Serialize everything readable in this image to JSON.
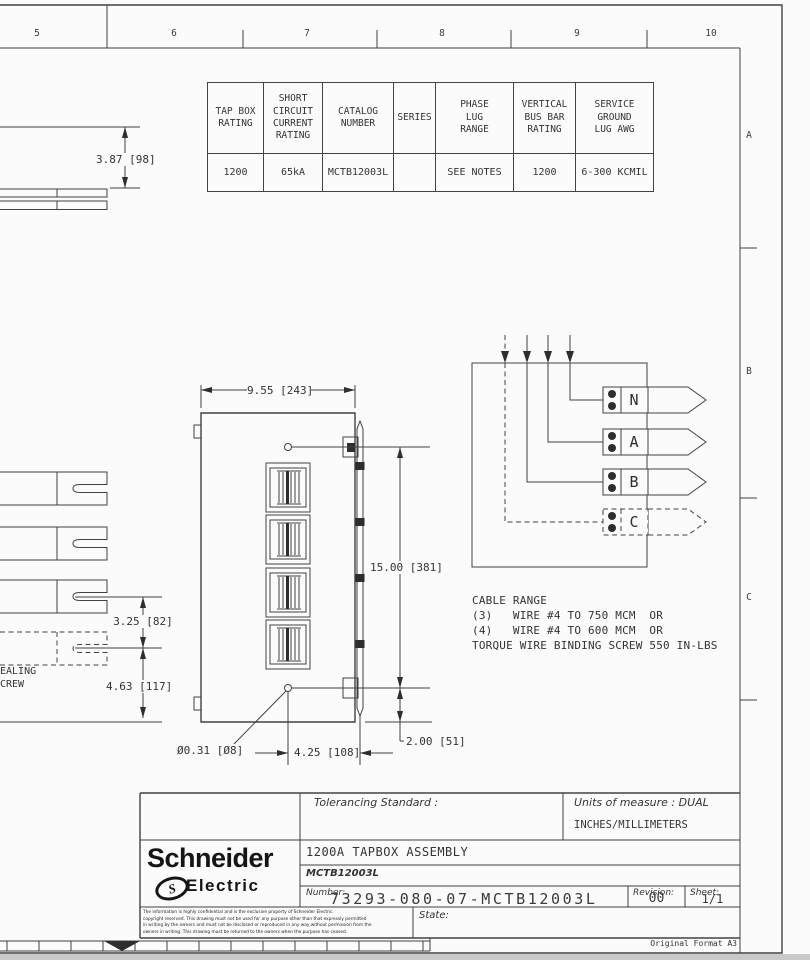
{
  "zones": {
    "top": [
      "5",
      "6",
      "7",
      "8",
      "9",
      "10"
    ],
    "right": [
      "A",
      "B",
      "C"
    ]
  },
  "spec_table": {
    "headers": [
      "TAP BOX\nRATING",
      "SHORT\nCIRCUIT\nCURRENT\nRATING",
      "CATALOG\nNUMBER",
      "SERIES",
      "PHASE\nLUG\nRANGE",
      "VERTICAL\nBUS BAR\nRATING",
      "SERVICE\nGROUND\nLUG AWG"
    ],
    "values": [
      "1200",
      "65kA",
      "MCTB12003L",
      "",
      "SEE NOTES",
      "1200",
      "6-300 KCMIL"
    ]
  },
  "dimensions": {
    "d387": "3.87 [98]",
    "d955": "9.55 [243]",
    "d1500": "15.00 [381]",
    "d325": "3.25 [82]",
    "d463": "4.63 [117]",
    "d031": "Ø0.31 [Ø8]",
    "d425": "4.25 [108]",
    "d200": "2.00 [51]"
  },
  "left_view": {
    "note_line1": "EALING",
    "note_line2": "CREW"
  },
  "phases": [
    "N",
    "A",
    "B",
    "C"
  ],
  "notes": {
    "cable_range": [
      "CABLE RANGE",
      "(3)   WIRE #4 TO 750 MCM  OR",
      "(4)   WIRE #4 TO 600 MCM  OR",
      "TORQUE WIRE BINDING SCREW 550 IN-LBS"
    ]
  },
  "title_block": {
    "tolerancing_label": "Tolerancing Standard :",
    "units_label": "Units of measure : DUAL",
    "units_value": "INCHES/MILLIMETERS",
    "brand_line1": "Schneider",
    "brand_glyph": "S",
    "brand_line2": "Electric",
    "title": "1200A TAPBOX ASSEMBLY",
    "subtitle": "MCTB12003L",
    "number_label": "Number:",
    "number": "73293-080-07-MCTB12003L",
    "revision_label": "Revision:",
    "revision": "00",
    "sheet_label": "Sheet:",
    "sheet": "1/1",
    "state_label": "State:",
    "legal": [
      "The information is highly confidential and is the exclusive property of Schneider Electric.",
      "copyright reserved.  This drawing must not be used for any purpose other than that expressly permitted",
      "in writing by the owners and must not be disclosed or reproduced in any way without permission from the",
      "owners in writing.  This drawing must be returned to the owners when the purpose has ceased."
    ],
    "format_note": "Original Format A3"
  }
}
